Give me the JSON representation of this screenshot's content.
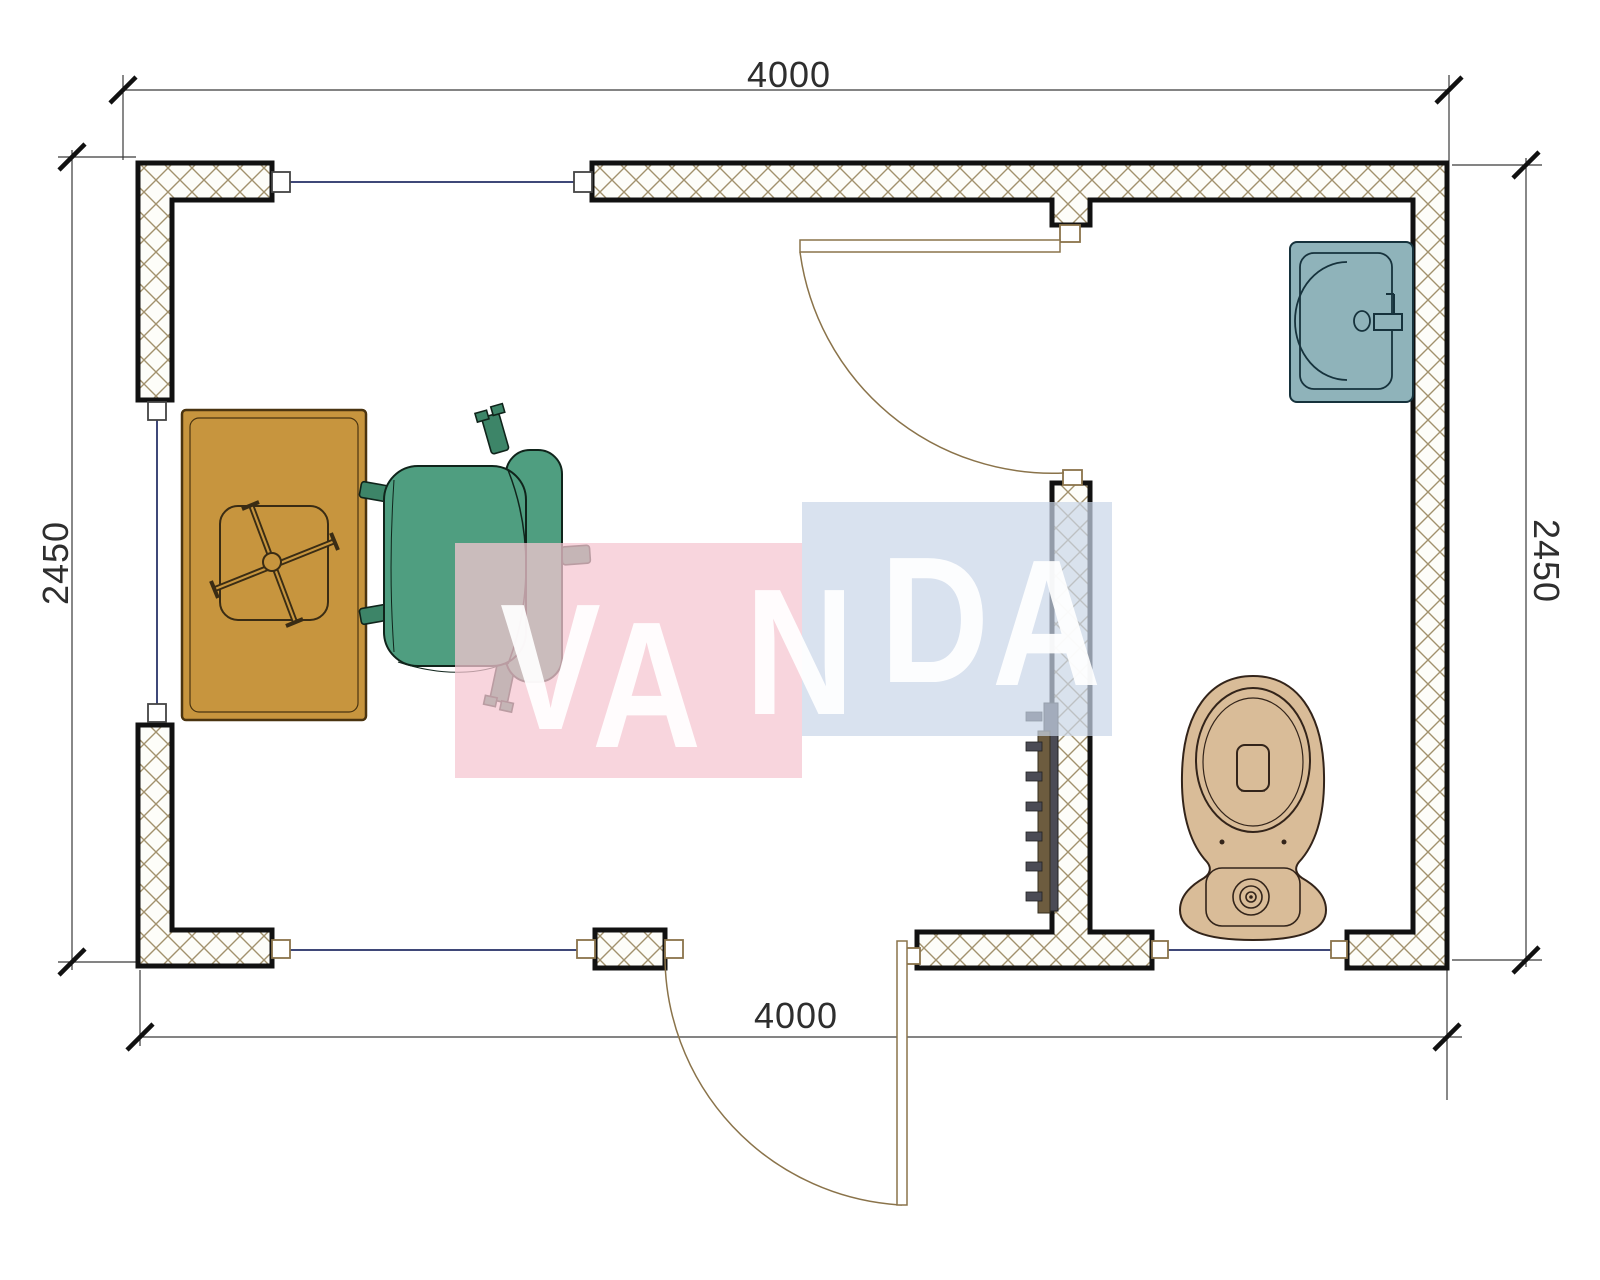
{
  "dimensions": {
    "top": "4000",
    "bottom": "4000",
    "left": "2450",
    "right": "2450"
  },
  "watermark": {
    "text": "VANDA",
    "letters": [
      "V",
      "A",
      "N",
      "D",
      "A"
    ],
    "pink_color": "#f6c7d1",
    "blue_color": "#c9d6e8",
    "letter_color": "#ffffff"
  },
  "colors": {
    "wall_outline": "#111111",
    "wall_hatch": "#a2916d",
    "window_glass_line": "#3f4878",
    "door_line": "#8a734a",
    "desk": "#c7953e",
    "chair": "#4f9e80",
    "chair_leg": "#3d8568",
    "sink": "#8fb3ba",
    "toilet": "#d9bc98",
    "radiator_plate": "#4b4b55",
    "radiator_bar": "#6d5c3f",
    "dimension_line": "#3a3a3a"
  },
  "fixtures": {
    "items": [
      "desk",
      "desk-chair-base",
      "office-chair",
      "interior-door",
      "entrance-door",
      "sink",
      "toilet",
      "radiator",
      "window-top",
      "window-left",
      "window-bottom-left",
      "window-bathroom"
    ]
  }
}
